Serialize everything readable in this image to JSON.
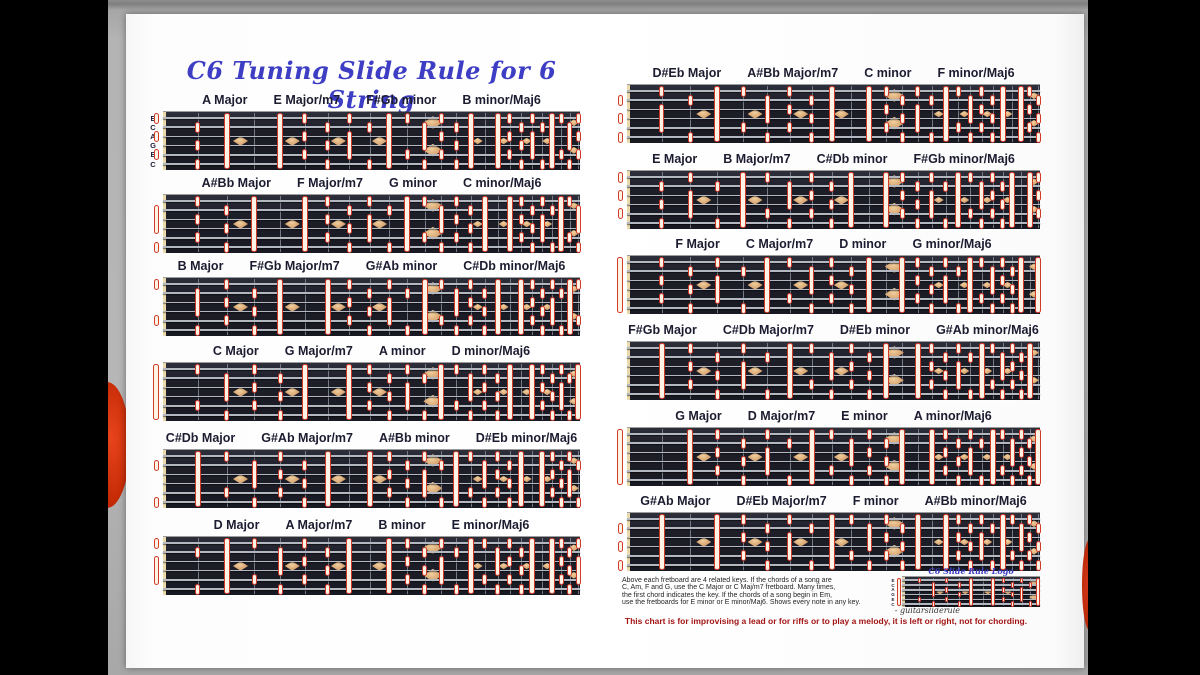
{
  "title": "C6 Tuning Slide Rule for 6 String",
  "music": {
    "tuning_labels": [
      "E",
      "C",
      "A",
      "G",
      "E",
      "C"
    ],
    "tuning_semitones": [
      4,
      0,
      9,
      7,
      4,
      0
    ],
    "major_scale_intervals": [
      0,
      2,
      4,
      5,
      7,
      9,
      11
    ],
    "frets": 24,
    "inlays_single": [
      3,
      5,
      7,
      9,
      15,
      17,
      19,
      21
    ],
    "inlays_double": [
      12,
      24
    ]
  },
  "columns": {
    "left": [
      {
        "root": "A",
        "root_pc": 9,
        "string_labels": true,
        "labels": [
          "A Major",
          "E Major/m7",
          "F#Gb minor",
          "B minor/Maj6"
        ]
      },
      {
        "root": "A#Bb",
        "root_pc": 10,
        "labels": [
          "A#Bb Major",
          "F Major/m7",
          "G minor",
          "C minor/Maj6"
        ]
      },
      {
        "root": "B",
        "root_pc": 11,
        "labels": [
          "B Major",
          "F#Gb Major/m7",
          "G#Ab minor",
          "C#Db minor/Maj6"
        ]
      },
      {
        "root": "C",
        "root_pc": 0,
        "labels": [
          "C Major",
          "G Major/m7",
          "A minor",
          "D minor/Maj6"
        ]
      },
      {
        "root": "C#Db",
        "root_pc": 1,
        "labels": [
          "C#Db Major",
          "G#Ab Major/m7",
          "A#Bb minor",
          "D#Eb minor/Maj6"
        ]
      },
      {
        "root": "D",
        "root_pc": 2,
        "labels": [
          "D Major",
          "A Major/m7",
          "B minor",
          "E minor/Maj6"
        ]
      }
    ],
    "right": [
      {
        "root": "D#Eb",
        "root_pc": 3,
        "labels": [
          "D#Eb Major",
          "A#Bb Major/m7",
          "C minor",
          "F minor/Maj6"
        ]
      },
      {
        "root": "E",
        "root_pc": 4,
        "labels": [
          "E Major",
          "B Major/m7",
          "C#Db minor",
          "F#Gb minor/Maj6"
        ]
      },
      {
        "root": "F",
        "root_pc": 5,
        "labels": [
          "F Major",
          "C Major/m7",
          "D minor",
          "G minor/Maj6"
        ]
      },
      {
        "root": "F#Gb",
        "root_pc": 6,
        "labels": [
          "F#Gb Major",
          "C#Db Major/m7",
          "D#Eb minor",
          "G#Ab minor/Maj6"
        ]
      },
      {
        "root": "G",
        "root_pc": 7,
        "labels": [
          "G Major",
          "D Major/m7",
          "E minor",
          "A minor/Maj6"
        ]
      },
      {
        "root": "G#Ab",
        "root_pc": 8,
        "labels": [
          "G#Ab Major",
          "D#Eb Major/m7",
          "F minor",
          "A#Bb minor/Maj6"
        ]
      }
    ]
  },
  "footer": {
    "note_lines": [
      "Above each fretboard are 4 related keys.  If the chords of a song are",
      "C, Am, F and G, use the C Major or C Maj/m7 fretboard.  Many times,",
      "the first chord indicates the key.  If the chords of a song begin in Em,",
      "use the fretboards for E minor or E minor/Maj6.  Shows every note in any key."
    ],
    "signature": "- guitarsliderule",
    "logo_label": "C6 Slide Rule Logo",
    "logo_root_pc": 0,
    "red_note": "This chart is for improvising a lead or for riffs or to play a melody, it is left or right, not for chording."
  },
  "colors": {
    "title_blue": "#3e3ec4",
    "label_navy": "#1c1c31",
    "marker_red": "#d23a2a",
    "marker_fill": "#fdf4e6",
    "board_dark": "#1e1f29",
    "string_gray": "#b3b7c0",
    "fret_gray": "#757a85",
    "nut_cream": "#ead9ab",
    "inlay_tan": "#d8a672",
    "footer_red": "#a31414",
    "decoration_red": "#c22803",
    "page_white": "#ffffff",
    "band_gray": "#b4b4b4"
  }
}
